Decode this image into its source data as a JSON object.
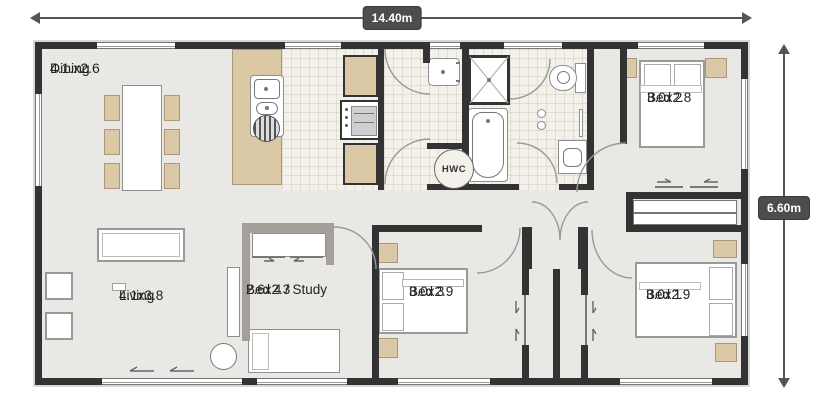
{
  "dimensions": {
    "width_label": "14.40m",
    "height_label": "6.60m"
  },
  "rooms": {
    "dining": {
      "name": "Dining",
      "size": "4.1.x2.6"
    },
    "living": {
      "name": "Living",
      "size": "4.1x3.8"
    },
    "bed4": {
      "name": "Bed 4 / Study",
      "size": "2.6x2.3"
    },
    "bed3": {
      "name": "Bed 3",
      "size": "3.0x2.9"
    },
    "bed2": {
      "name": "Bed 2",
      "size": "3.0x2.8"
    },
    "bed1": {
      "name": "Bed 1",
      "size": "3.0x2.9"
    }
  },
  "fixtures": {
    "hwc_label": "HWC"
  },
  "colors": {
    "wall": "#333333",
    "floor": "#eae8e4",
    "tile": "#f4f1ea",
    "timber": "#dbc9a6",
    "dimension_badge": "#4d4d4d",
    "partition_gray": "#a3a09c"
  }
}
